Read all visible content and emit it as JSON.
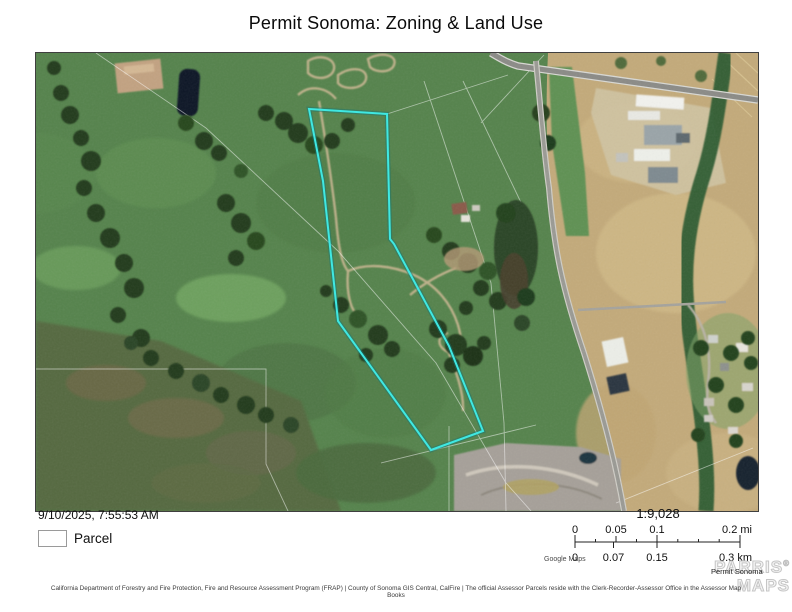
{
  "title": "Permit Sonoma: Zoning & Land Use",
  "map": {
    "timestamp": "9/10/2025, 7:55:53 AM",
    "legend": {
      "parcel_label": "Parcel"
    },
    "scale": {
      "ratio": "1:9,028",
      "mi_ticks": [
        "0",
        "0.05",
        "0.1",
        "0.2 mi"
      ],
      "km_ticks": [
        "0",
        "0.07",
        "0.15",
        "0.3 km"
      ]
    },
    "basemap_credit": "Google Maps",
    "attribution": "California Department of Forestry and Fire Protection, Fire and Resource Assessment Program (FRAP) | County of Sonoma GIS Central, CalFire | The official Assessor Parcels reside with the Clerk-Recorder-Assessor Office in the Assessor Map Books",
    "watermark": {
      "line1": "PARRIS",
      "line2": "MAPS",
      "registered": "®",
      "label": "Permit Sonoma"
    },
    "colors": {
      "parcel_outline": "#3fe8e2",
      "pasture_green": "#55834c",
      "dry_field_gold": "#c3aa7a",
      "road_gray": "#8b8b87"
    }
  }
}
